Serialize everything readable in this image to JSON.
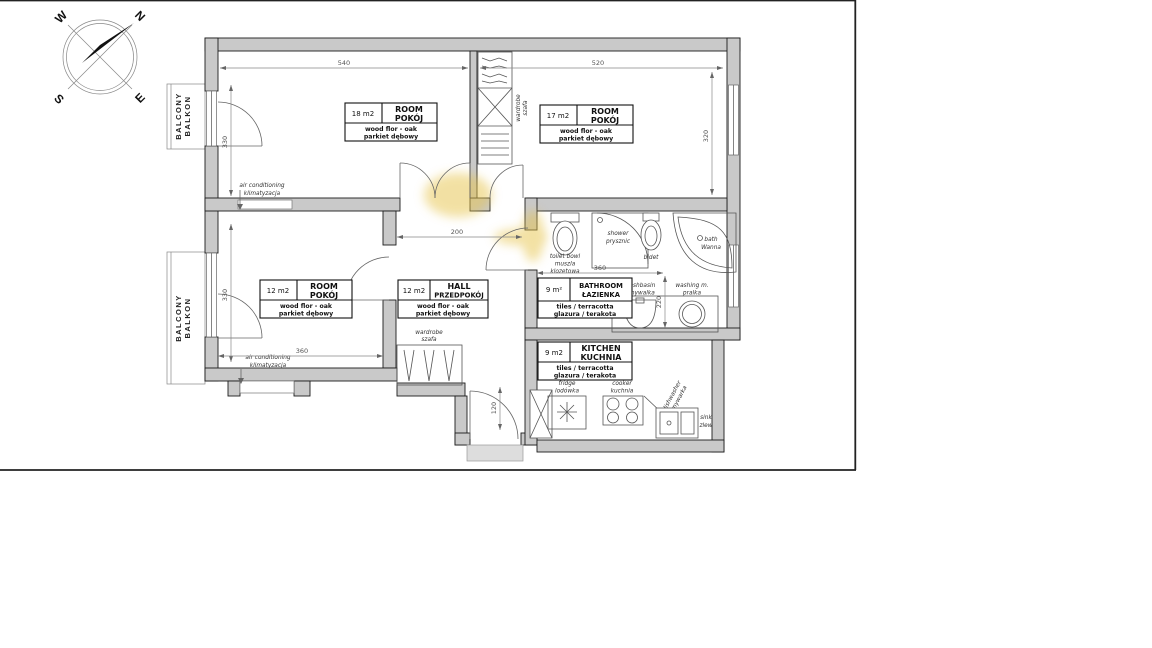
{
  "compass": {
    "n": "N",
    "e": "E",
    "s": "S",
    "w": "W"
  },
  "balcony": {
    "en": "BALCONY",
    "pl": "BALKON"
  },
  "rooms": {
    "room18": {
      "area": "18 m2",
      "en": "ROOM",
      "pl": "POKÓJ",
      "floor_en": "wood flor - oak",
      "floor_pl": "parkiet dębowy"
    },
    "room17": {
      "area": "17 m2",
      "en": "ROOM",
      "pl": "POKÓJ",
      "floor_en": "wood flor - oak",
      "floor_pl": "parkiet dębowy"
    },
    "room12": {
      "area": "12 m2",
      "en": "ROOM",
      "pl": "POKÓJ",
      "floor_en": "wood flor - oak",
      "floor_pl": "parkiet dębowy"
    },
    "hall": {
      "area": "12 m2",
      "en": "HALL",
      "pl": "PRZEDPOKÓJ",
      "floor_en": "wood flor - oak",
      "floor_pl": "parkiet dębowy"
    },
    "bathroom": {
      "area": "9 m²",
      "en": "BATHROOM",
      "pl": "ŁAZIENKA",
      "floor_en": "tiles / terracotta",
      "floor_pl": "glazura / terakota"
    },
    "kitchen": {
      "area": "9 m2",
      "en": "KITCHEN",
      "pl": "KUCHNIA",
      "floor_en": "tiles / terracotta",
      "floor_pl": "glazura / terakota"
    }
  },
  "fixtures": {
    "toilet": {
      "en": "toilet bowl",
      "pl1": "muszla",
      "pl2": "klozetowa"
    },
    "shower": {
      "en": "shower",
      "pl": "prysznic"
    },
    "bidet": {
      "en": "bidet"
    },
    "bath": {
      "en": "bath",
      "pl": "Wanna"
    },
    "washbasin": {
      "en": "washbasin",
      "pl": "umywalka"
    },
    "washing_machine": {
      "en": "washing m.",
      "pl": "pralka"
    },
    "fridge": {
      "en": "fridge",
      "pl": "lodówka"
    },
    "cooker": {
      "en": "cooker",
      "pl": "kuchnia"
    },
    "dishwasher": {
      "en": "dishwasher",
      "pl": "zmywarka"
    },
    "sink": {
      "en": "sink",
      "pl": "zlew"
    },
    "wardrobe": {
      "en": "wardrobe",
      "pl": "szafa"
    },
    "air_conditioning": {
      "en": "air conditioning",
      "pl": "klimatyzacja"
    }
  },
  "dimensions": {
    "room18_width": "540",
    "room17_width": "520",
    "room17_height": "320",
    "room18_height": "330",
    "room12_height": "330",
    "room12_width": "360",
    "hall_width": "200",
    "bathroom_width": "360",
    "bathroom_height": "220",
    "entrance": "120"
  },
  "colors": {
    "wall_fill": "#c9c9c9",
    "outline": "#1c1c1c",
    "highlight": "#e6c349"
  }
}
